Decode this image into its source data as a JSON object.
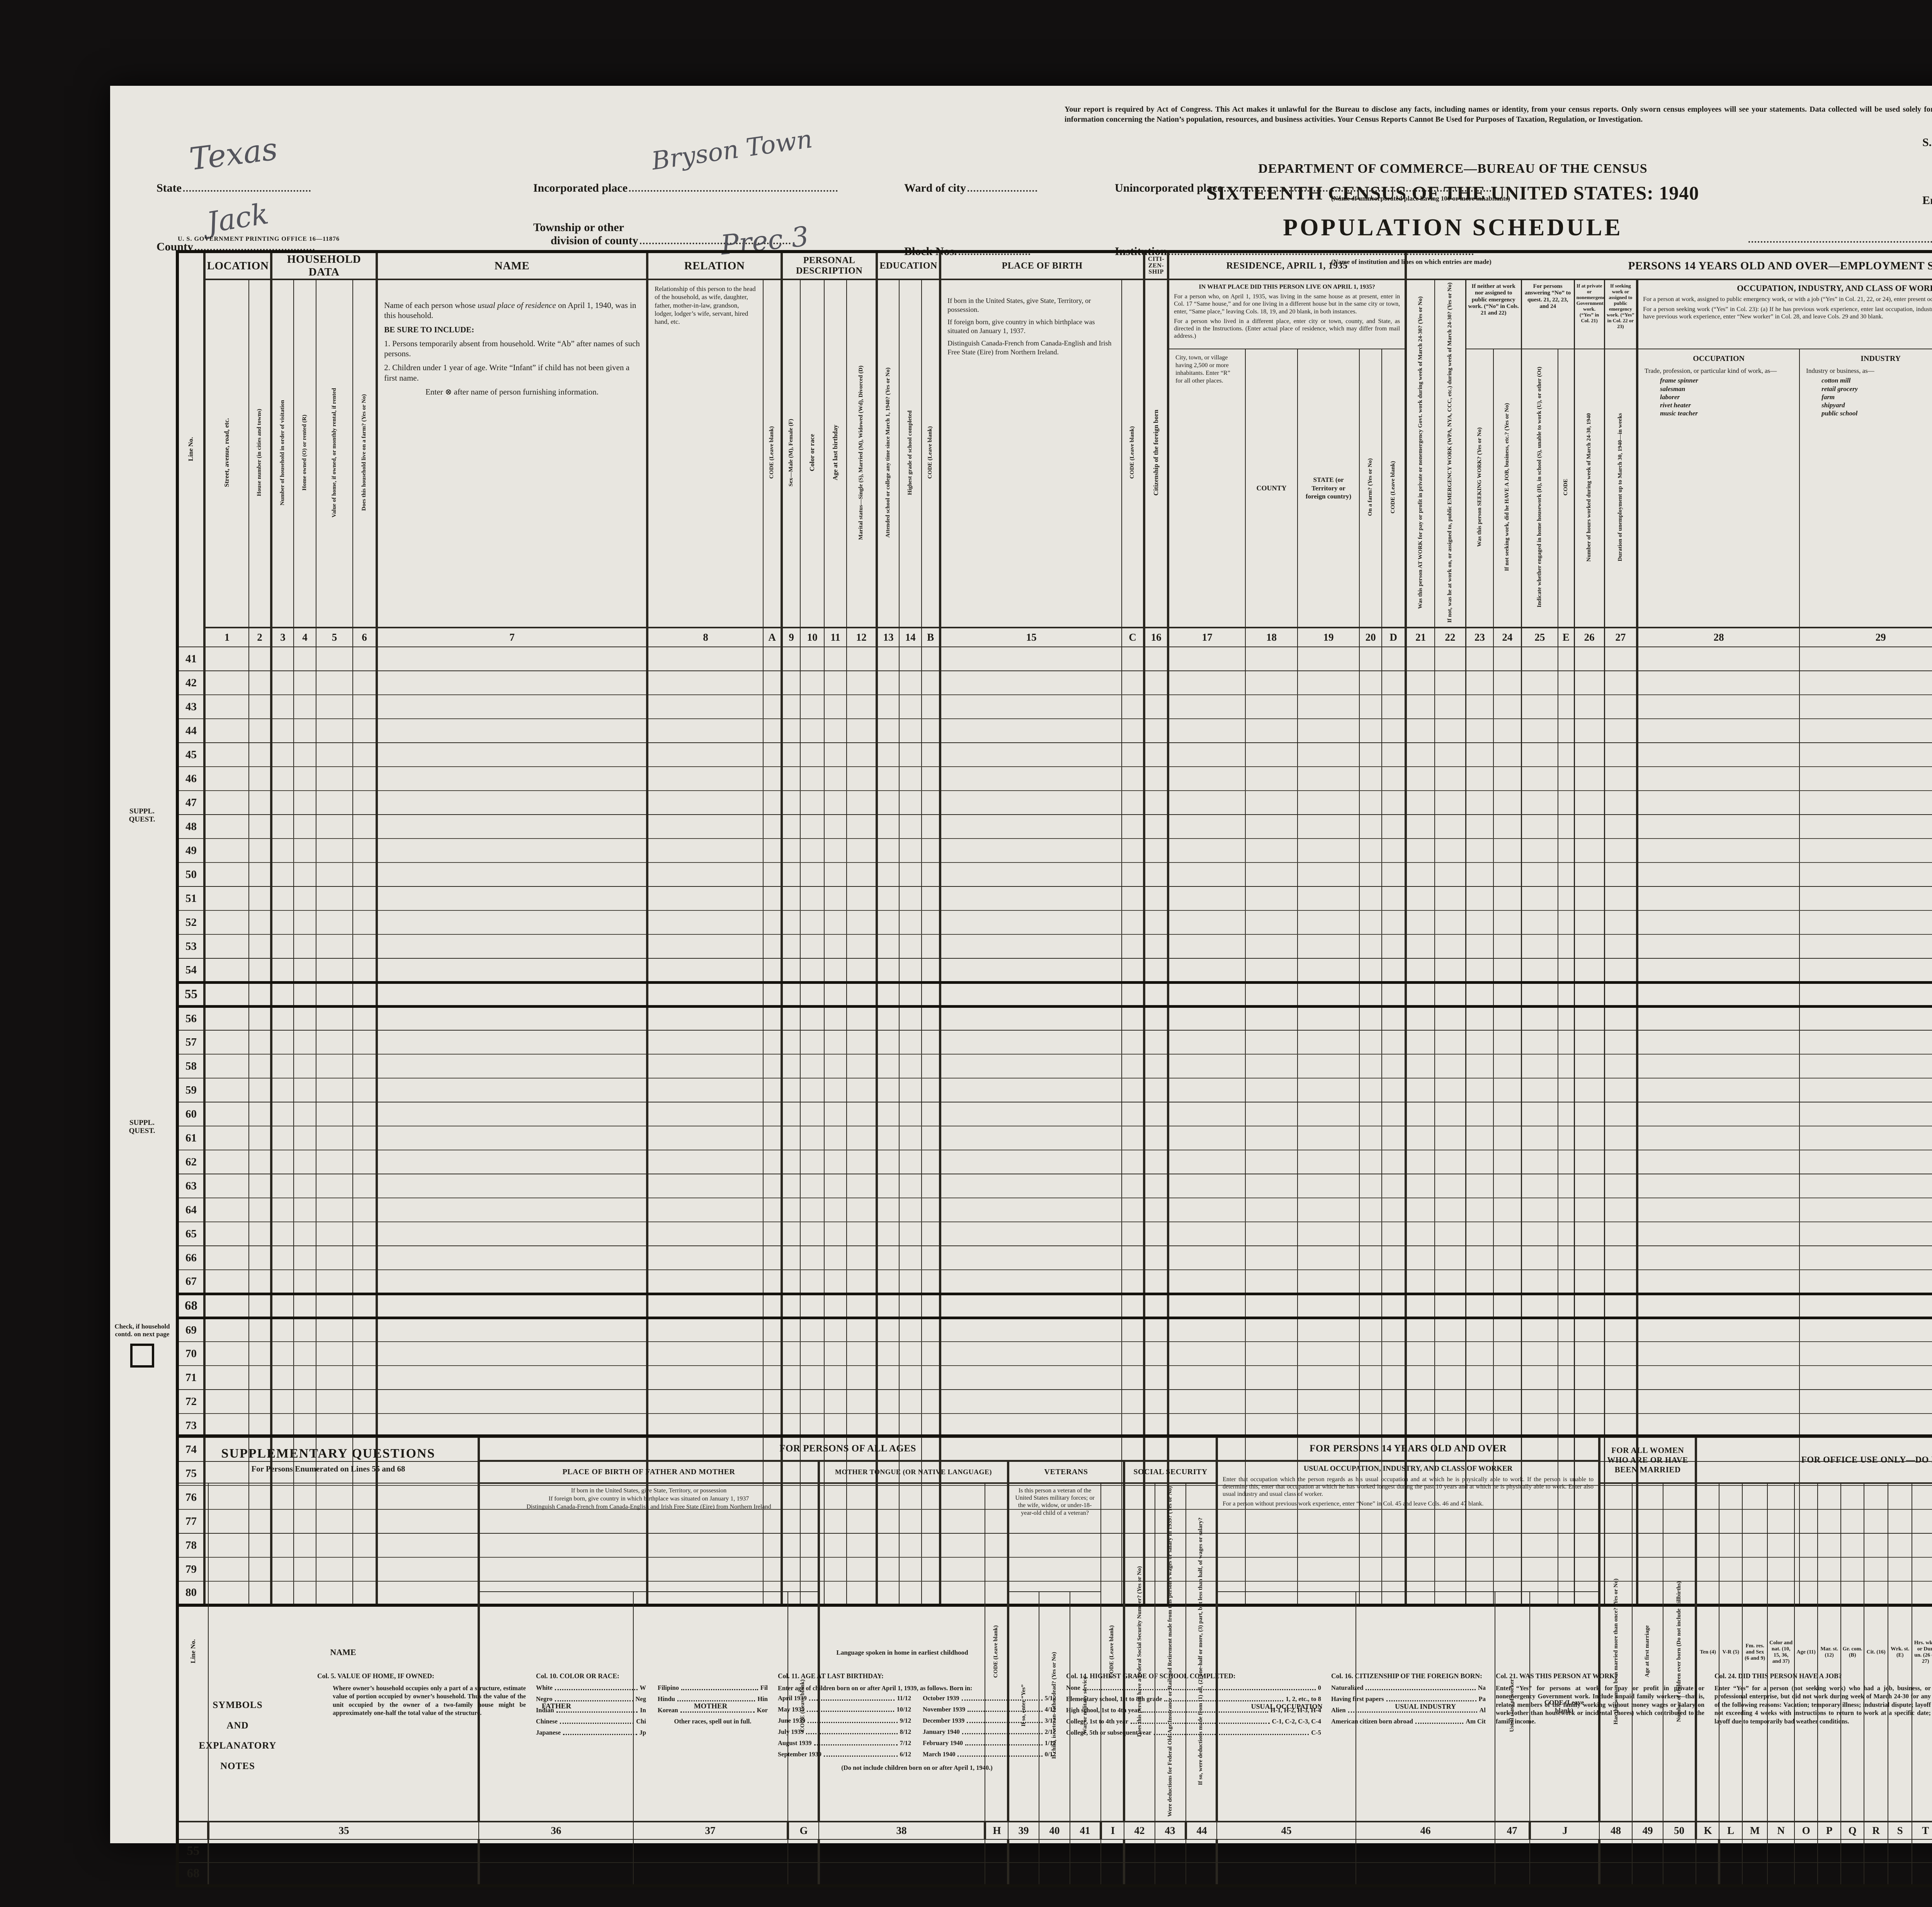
{
  "page": {
    "notice": "Your report is required by Act of Congress.  This Act makes it unlawful for the Bureau to disclose any facts, including names or identity, from your census reports.  Only sworn census employees will see your statements.  Data collected will be used solely for preparing statistical information concerning the Nation’s population, resources, and business activities.  Your Census Reports Cannot Be Used for Purposes of Taxation, Regulation, or Investigation.",
    "department": "DEPARTMENT OF COMMERCE—BUREAU OF THE CENSUS",
    "census_title": "SIXTEENTH CENSUS OF THE UNITED STATES: 1940",
    "schedule_title": "POPULATION SCHEDULE",
    "form_number": "16-252 A",
    "printing_office": "U. S. GOVERNMENT PRINTING OFFICE      16—11876"
  },
  "fields": {
    "state_label": "State",
    "state_value": "Texas",
    "county_label": "County",
    "county_value": "Jack",
    "incorporated_label": "Incorporated place",
    "incorporated_value": "Bryson Town",
    "ward_label": "Ward of city",
    "unincorporated_label": "Unincorporated place",
    "unincorporated_caption": "(Name of unincorporated place having 100 or more inhabitants)",
    "township_label_1": "Township or other",
    "township_label_2": "division of county",
    "township_value": "Prec 3",
    "block_label": "Block Nos.",
    "institution_label": "Institution",
    "institution_caption": "(Name of institution and lines on which entries are made)",
    "sd_label": "S. D. No.",
    "sd_value": "13",
    "ed_label": "E. D. No.",
    "ed_value": "119-6",
    "sheet_label": "Sheet No.",
    "sheet_value": "61",
    "sheet_letter": "B",
    "enumerated_label": "Enumerated by me on",
    "enumerated_year": ", 1940.",
    "enumerator_label": "Enumerator."
  },
  "margins": {
    "suppl_quest_1": "SUPPL.",
    "suppl_quest_2": "QUEST.",
    "check_note": "Check, if household contd. on next page"
  },
  "main_table": {
    "line_no": "Line No.",
    "bands": {
      "location": "LOCATION",
      "household": "HOUSEHOLD DATA",
      "name": "NAME",
      "relation": "RELATION",
      "personal": "PERSONAL DESCRIPTION",
      "education": "EDUCATION",
      "birth": "PLACE OF BIRTH",
      "citizenship": "CITI- ZEN- SHIP",
      "residence": "RESIDENCE, APRIL 1, 1935",
      "employment": "PERSONS 14 YEARS OLD AND OVER—EMPLOYMENT STATUS"
    },
    "cols": {
      "c1": "Street, avenue, road, etc.",
      "c2": "House number (in cities and towns)",
      "c3": "Number of household in order of visitation",
      "c4": "Home owned (O) or rented (R)",
      "c5": "Value of home, if owned, or monthly rental, if rented",
      "c6": "Does this household live on a farm?  (Yes or No)",
      "c9": "Sex—Male (M), Female (F)",
      "c10": "Color or race",
      "c11": "Age at last birthday",
      "c12": "Marital status—Single (S), Married (M), Widowed (Wd), Divorced (D)",
      "c13": "Attended school or college any time since March 1, 1940?  (Yes or No)",
      "c14": "Highest grade of school completed",
      "c16": "Citizenship of the foreign born",
      "c20": "On a farm? (Yes or No)",
      "c21": "Was this person AT WORK for pay or profit in private or nonemergency Govt. work during week of March 24-30?  (Yes or No)",
      "c22": "If not, was he at work on, or assigned to, public EMERGENCY WORK (WPA, NYA, CCC, etc.) during week of March 24-30?  (Yes or No)",
      "c23": "Was this person SEEKING WORK?  (Yes or No)",
      "c24": "If not seeking work, did he HAVE A JOB, business, etc.?  (Yes or No)",
      "c25": "Indicate whether engaged in home housework (H), in school (S), unable to work (U), or other (Ot)",
      "c26": "Number of hours worked during week of March 24-30, 1940",
      "c27": "Duration of unemployment up to March 30, 1940—in weeks",
      "c30": "Class of worker",
      "c31": "Number of weeks worked in 1939 (Equivalent full-time weeks)",
      "c32": "Amount of money wages or salary received (including commissions)",
      "c33": "Did this person receive income of $50 or more from sources other than money wages or salary?  (Yes or No)",
      "c34": "Number of Farm Schedule"
    },
    "code": "CODE",
    "code_leave_blank": "CODE (Leave blank)",
    "name_desc": {
      "p1a": "Name of each person whose ",
      "p1b": "usual place of residence",
      "p1c": " on April 1, 1940, was in this household.",
      "p2": "BE SURE TO INCLUDE:",
      "p3": "1. Persons temporarily absent from household.  Write “Ab” after names of such persons.",
      "p4": "2. Children under 1 year of age.  Write “Infant” if child has not been given a first name.",
      "p5": "Enter ⊗ after name of person furnishing information."
    },
    "relation_desc": "Relationship of this person to the head of the household, as wife, daughter, father, mother-in-law, grandson, lodger, lodger’s wife, servant, hired hand, etc.",
    "birth_desc": {
      "p1": "If born in the United States, give State, Territory, or possession.",
      "p2": "If foreign born, give country in which birthplace was situated on January 1, 1937.",
      "p3": "Distinguish Canada-French from Canada-English and Irish Free State (Eire) from Northern Ireland."
    },
    "residence": {
      "q": "IN WHAT PLACE DID THIS PERSON LIVE ON APRIL 1, 1935?",
      "p1": "For a person who, on April 1, 1935, was living in the same house as at present, enter in Col. 17 “Same house,” and for one living in a different house but in the same city or town, enter, “Same place,” leaving Cols. 18, 19, and 20 blank, in both instances.",
      "p2": "For a person who lived in a different place, enter city or town, county, and State, as directed in the Instructions.  (Enter actual place of residence, which may differ from mail address.)",
      "c17": "City, town, or village having 2,500 or more inhabitants.  Enter “R” for all other places.",
      "c18": "COUNTY",
      "c19": "STATE (or Territory or foreign country)"
    },
    "employment": {
      "band_23_24": "If neither at work nor assigned to public emergency work.  (“No” in Cols. 21 and 22)",
      "band_25": "For persons answering “No” to quest. 21, 22, 23, and 24",
      "band_26": "If at private or nonemergency Government work.  (“Yes” in Col. 21)",
      "band_27": "If seeking work or assigned to public emergency work.  (“Yes” in Col. 22 or 23)",
      "occ_band": "OCCUPATION, INDUSTRY, AND CLASS OF WORKER",
      "occ_p1": "For a person at work, assigned to public emergency work, or with a job (“Yes” in Col. 21, 22, or 24), enter present occupation, industry, and class of worker.",
      "occ_p2": "For a person seeking work (“Yes” in Col. 23):  (a) If he has previous work experience, enter last occupation, industry, and class of worker; or (b) if he does not have previous work experience, enter “New worker” in Col. 28, and leave Cols. 29 and 30 blank.",
      "c28_title": "OCCUPATION",
      "c28_desc": "Trade, profession, or particular kind of work, as—",
      "c28_examples": [
        "frame spinner",
        "salesman",
        "laborer",
        "rivet heater",
        "music teacher"
      ],
      "c29_title": "INDUSTRY",
      "c29_desc": "Industry or business, as—",
      "c29_examples": [
        "cotton mill",
        "retail grocery",
        "farm",
        "shipyard",
        "public school"
      ],
      "income_band": "INCOME IN 1939 (12 months ending December 31, 1939)"
    },
    "numbers": [
      "1",
      "2",
      "3",
      "4",
      "5",
      "6",
      "7",
      "8",
      "A",
      "9",
      "10",
      "11",
      "12",
      "13",
      "14",
      "B",
      "15",
      "C",
      "16",
      "17",
      "18",
      "19",
      "20",
      "D",
      "21",
      "22",
      "23",
      "24",
      "25",
      "E",
      "26",
      "27",
      "28",
      "29",
      "30",
      "F",
      "31",
      "32",
      "33",
      "34"
    ],
    "line_numbers": [
      41,
      42,
      43,
      44,
      45,
      46,
      47,
      48,
      49,
      50,
      51,
      52,
      53,
      54,
      55,
      56,
      57,
      58,
      59,
      60,
      61,
      62,
      63,
      64,
      65,
      66,
      67,
      68,
      69,
      70,
      71,
      72,
      73,
      74,
      75,
      76,
      77,
      78,
      79,
      80
    ]
  },
  "supp_table": {
    "title": "SUPPLEMENTARY QUESTIONS",
    "subtitle": "For Persons Enumerated on Lines 55 and 68",
    "line_no": "Line No.",
    "name_label": "NAME",
    "band_all_ages": "FOR PERSONS OF ALL AGES",
    "band_14": "FOR PERSONS 14 YEARS OLD AND OVER",
    "band_women": "FOR ALL WOMEN WHO ARE OR HAVE BEEN MARRIED",
    "band_office": "FOR OFFICE USE ONLY—DO NOT WRITE IN THESE COLUMNS",
    "pob_band": "PLACE OF BIRTH OF FATHER AND MOTHER",
    "pob_instr_1": "If born in the United States, give State, Territory, or possession",
    "pob_instr_2": "If foreign born, give country in which birthplace was situated on January 1, 1937",
    "pob_instr_3": "Distinguish Canada-French from Canada-English and Irish Free State (Eire) from Northern Ireland",
    "father": "FATHER",
    "mother": "MOTHER",
    "code_leave_blank": "CODE (Leave blank)",
    "tongue_band": "MOTHER TONGUE (OR NATIVE LANGUAGE)",
    "tongue_col": "Language spoken in home in earliest childhood",
    "vet_band": "VETERANS",
    "vet_instr": "Is this person a veteran of the United States military forces; or the wife, widow, or under-18-year-old child of a veteran?",
    "v39": "If so, enter “Yes”",
    "v40": "If child, is veteran-father dead?  (Yes or No)",
    "v41": "War or military service",
    "ss_band": "SOCIAL SECURITY",
    "s42": "Does this person have a Federal Social Security Number?  (Yes or No)",
    "s43": "Were deductions for Federal Old-Age Insurance or Railroad Retirement made from this person’s wages or salary in 1939?  (Yes or No)",
    "s44": "If so, were deductions made from (1) all, (2) one-half or more, (3) part, but less than half, of wages or salary?",
    "occ_band": "USUAL OCCUPATION, INDUSTRY, AND CLASS OF WORKER",
    "occ_p1": "Enter that occupation which the person regards as his usual occupation and at which he is physically able to work.  If the person is unable to determine this, enter that occupation at which he has worked longest during the past 10 years and at which he is physically able to work.  Enter also usual industry and usual class of worker.",
    "occ_p2": "For a person without previous work experience, enter “None” in Col. 45 and leave Cols. 46 and 47 blank.",
    "u45": "USUAL OCCUPATION",
    "u46": "USUAL INDUSTRY",
    "u47": "Usual class of worker",
    "w48": "Has this woman been married more than once?  (Yes or No)",
    "w49": "Age at first marriage",
    "w50": "Number of children ever born (Do not include stillbirths)",
    "office_cols": [
      {
        "letter": "K",
        "label": "Ten (4)"
      },
      {
        "letter": "L",
        "label": "V-R (5)"
      },
      {
        "letter": "M",
        "label": "Fm. res. and Sex (6 and 9)"
      },
      {
        "letter": "N",
        "label": "Color and nat. (10, 15, 36, and 37)"
      },
      {
        "letter": "O",
        "label": "Age (11)"
      },
      {
        "letter": "P",
        "label": "Mar. st. (12)"
      },
      {
        "letter": "Q",
        "label": "Gr. com. (B)"
      },
      {
        "letter": "R",
        "label": "Cit. (16)"
      },
      {
        "letter": "S",
        "label": "Wrk. st. (E)"
      },
      {
        "letter": "T",
        "label": "Hrs. wkd. or Dur. un. (26 or 27)"
      },
      {
        "letter": "U",
        "label": "Occupation, industry, and class of worker (F)"
      },
      {
        "letter": "V",
        "label": "Wks. wkd. (31)"
      },
      {
        "letter": "W",
        "label": "Wages (32)"
      },
      {
        "letter": "X",
        "label": "Ot. inc. (33)"
      },
      {
        "letter": "Y",
        "label": ""
      },
      {
        "letter": "Z",
        "label": ""
      }
    ],
    "numbers": [
      "35",
      "36",
      "37",
      "G",
      "38",
      "H",
      "39",
      "40",
      "41",
      "I",
      "42",
      "43",
      "44",
      "45",
      "46",
      "47",
      "J",
      "48",
      "49",
      "50"
    ],
    "rows": [
      "55",
      "68"
    ]
  },
  "notes": {
    "sidebar": [
      "SYMBOLS",
      "AND",
      "EXPLANATORY",
      "NOTES"
    ],
    "col5": {
      "title": "Col. 5. VALUE OF HOME, IF OWNED:",
      "body": "Where owner’s household occupies only a part of a structure, estimate value of portion occupied by owner’s household.  Thus the value of the unit occupied by the owner of a two-family house might be approximately one-half the total value of the structure."
    },
    "col10": {
      "title": "Col. 10. COLOR OR RACE:",
      "codes_left": [
        [
          "White",
          "W"
        ],
        [
          "Negro",
          "Neg"
        ],
        [
          "Indian",
          "In"
        ],
        [
          "Chinese",
          "Chi"
        ],
        [
          "Japanese",
          "Jp"
        ]
      ],
      "codes_right": [
        [
          "Filipino",
          "Fil"
        ],
        [
          "Hindu",
          "Hin"
        ],
        [
          "Korean",
          "Kor"
        ]
      ],
      "footer": "Other races, spell out in full."
    },
    "col11": {
      "title": "Col. 11. AGE AT LAST BIRTHDAY:",
      "intro": "Enter age of children born on or after April 1, 1939, as follows.  Born in:",
      "months_left": [
        [
          "April 1939",
          "11/12"
        ],
        [
          "May 1939",
          "10/12"
        ],
        [
          "June 1939",
          "9/12"
        ],
        [
          "July 1939",
          "8/12"
        ],
        [
          "August 1939",
          "7/12"
        ],
        [
          "September 1939",
          "6/12"
        ]
      ],
      "months_right": [
        [
          "October 1939",
          "5/12"
        ],
        [
          "November 1939",
          "4/12"
        ],
        [
          "December 1939",
          "3/12"
        ],
        [
          "January 1940",
          "2/12"
        ],
        [
          "February 1940",
          "1/12"
        ],
        [
          "March 1940",
          "0/12"
        ]
      ],
      "footer": "(Do not include children born on or after April 1, 1940.)"
    },
    "col14": {
      "title": "Col. 14. HIGHEST GRADE OF SCHOOL COMPLETED:",
      "codes": [
        [
          "None",
          "0"
        ],
        [
          "Elementary school, 1st to 8th grade",
          "1, 2, etc., to 8"
        ],
        [
          "High school, 1st to 4th year",
          "H-1, H-2, H-3, H-4"
        ],
        [
          "College, 1st to 4th year",
          "C-1, C-2, C-3, C-4"
        ],
        [
          "College, 5th or subsequent year",
          "C-5"
        ]
      ]
    },
    "col16": {
      "title": "Col. 16. CITIZENSHIP OF THE FOREIGN BORN:",
      "codes": [
        [
          "Naturalized",
          "Na"
        ],
        [
          "Having first papers",
          "Pa"
        ],
        [
          "Alien",
          "Al"
        ],
        [
          "American citizen born abroad",
          "Am Cit"
        ]
      ]
    },
    "col21": {
      "title": "Col. 21. WAS THIS PERSON AT WORK?",
      "body": "Enter “Yes” for persons at work for pay or profit in private or nonemergency Government work.  Include unpaid family workers—that is, related members of the family working without money wages or salary on work (other than housework or incidental chores) which contributed to the family income."
    },
    "col24": {
      "title": "Col. 24. DID THIS PERSON HAVE A JOB?",
      "body": "Enter “Yes” for a person (not seeking work) who had a job, business, or professional enterprise, but did not work during week of March 24-30 for any of the following reasons: Vacation; temporary illness; industrial dispute; layoff not exceeding 4 weeks with instructions to return to work at a specific date; layoff due to temporarily bad weather conditions."
    },
    "col30_47": {
      "title": "Cols. 30 and 47. CLASS OF WORKER:",
      "codes": [
        [
          "Wage or salary worker in private work",
          "PW"
        ],
        [
          "Wage or salary worker in Government work",
          "GW"
        ],
        [
          "Employer",
          "E"
        ],
        [
          "Working on own account",
          "OA"
        ],
        [
          "Unpaid family worker",
          "NP"
        ]
      ]
    },
    "col41": {
      "title": "Col. 41. WAR OR MILITARY SERVICE:",
      "codes": [
        [
          "World War",
          "W"
        ],
        [
          "Spanish-American War, Philippine Insurrection, or Boxer Rebellion",
          "S"
        ],
        [
          "Spanish-American War and World War",
          "SW"
        ],
        [
          "Regular establishment (Army, Navy, or Marine Corps) peace-time service only",
          "R"
        ],
        [
          "Other war or expedition",
          "Ot"
        ]
      ]
    }
  }
}
